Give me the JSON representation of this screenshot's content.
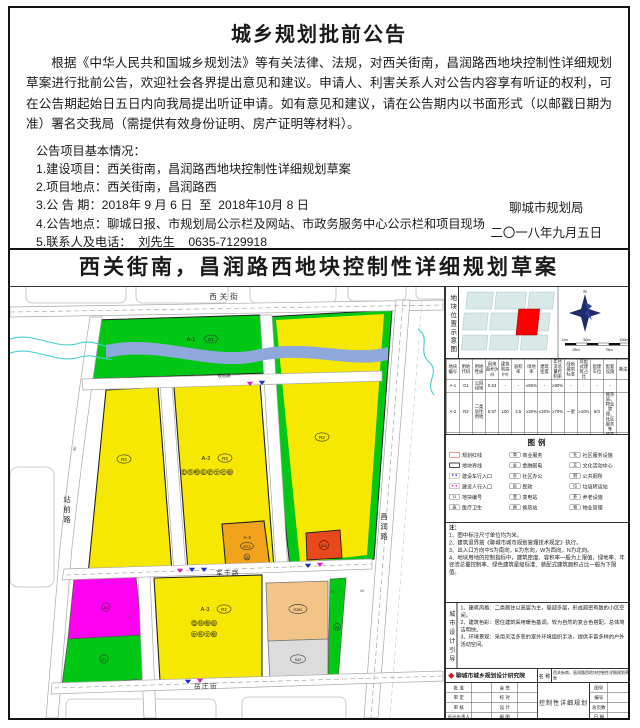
{
  "announcement": {
    "title": "城乡规划批前公告",
    "body": "根据《中华人民共和国城乡规划法》等有关法律、法规，对西关街南，昌润路西地块控制性详细规划草案进行批前公告，欢迎社会各界提出意见和建议。申请人、利害关系人对公告内容享有听证的权利，可在公告期起始日五日内向我局提出听证申请。如有意见和建议，请在公告期内以书面形式（以邮戳日期为准）署名交我局（需提供有效身份证明、房产证明等材料）。",
    "info_heading": "公告项目基本情况：",
    "items": [
      "1.建设项目：西关街南，昌润路西地块控制性详细规划草案",
      "2.项目地点：西关街南，昌润路西",
      "3.公 告 期：2018年 9 月 6 日  至  2018年10月 8 日",
      "4.公告地点：聊城日报、市规划局公示栏及网站、市政务服务中心公示栏和项目现场",
      "5.联系人及电话：  刘先生    0635-7129918"
    ],
    "signature_org": "聊城市规划局",
    "signature_date": "二〇一八年九月五日"
  },
  "map": {
    "title": "西关街南，昌润路西地块控制性详细规划草案",
    "roads": {
      "xiguan": "西关街",
      "zhanqian": "站前路",
      "changrun": "昌润路",
      "jungan": "军干路",
      "yuezhuang": "岳庄街",
      "guihua": "规划路"
    },
    "dims": {
      "d40a": "40",
      "d30": "30",
      "d16": "16",
      "d20": "20",
      "d40b": "40"
    },
    "blocks": {
      "a1_no": "A-1",
      "a1_code": "G1",
      "west_code": "R2",
      "a2_no": "A-2",
      "a2_code": "R2",
      "a2_amenities": "电热物居老文社厕",
      "east_code": "R2",
      "a4_no": "A-4",
      "a4_code": "R22",
      "a4_amenity": "幼",
      "a3_no": "A-3",
      "a3_code": "R2",
      "a3_amenities1": "电热物居",
      "a3_amenities2": "办民文厕",
      "magenta_code": "B4",
      "magenta_green_code": "G1",
      "red_code": "B41",
      "tan_code": "R2B1",
      "gray_code": "S42",
      "strip_code": "G2"
    }
  },
  "panel": {
    "inset": {
      "label": "地块位置示意图",
      "north": "N",
      "scale": [
        "0m",
        "25m",
        "50m",
        "75m",
        "100m"
      ]
    },
    "table": {
      "headers": [
        "地块编号",
        "用地代码",
        "用地性质",
        "用地面积(ha)",
        "建筑限高(m)",
        "容积率",
        "绿地率",
        "建筑密度",
        "年径流总量控制率",
        "绿色建筑标准",
        "装配式建筑占比",
        "配建车位",
        "配套设施",
        "备注"
      ],
      "rows": [
        [
          "A-1",
          "G1",
          "公园绿地",
          "0.53",
          "-",
          "-",
          "≥85%",
          "-",
          "≥90%",
          "-",
          "-",
          "-",
          "-",
          ""
        ],
        [
          "A-2",
          "R2",
          "二类居住用地",
          "5.57",
          "100",
          "2.5",
          "≥30%",
          "≤20%",
          "≥70%",
          "一星",
          "≥10%",
          "9/3",
          "换热站、物业管理、社区服务等",
          ""
        ],
        [
          "A-3",
          "R2",
          "二类居住用地",
          "3.88",
          "100",
          "2.8",
          "≥30%",
          "≤20%",
          "≥70%",
          "一星",
          "≥10%",
          "9/3",
          "换热站、物业管理、社区办公等",
          "代征"
        ],
        [
          "A-4",
          "R22",
          "服务设施用地",
          "0.53",
          "24",
          "0.8",
          "≥30%",
          "≤30%",
          "≥70%",
          "一星",
          "≥10%",
          "9/4",
          "幼儿园",
          ""
        ]
      ]
    },
    "legend": {
      "title": "图例",
      "columns": [
        [
          {
            "type": "rect-red",
            "label": "规划红线"
          },
          {
            "type": "rect-dark",
            "label": "地块界线"
          },
          {
            "type": "arrow-blue",
            "char": "▼▼",
            "label": "建设车行入口"
          },
          {
            "type": "arrow-magenta",
            "char": "▼▼",
            "label": "建设人行入口"
          },
          {
            "type": "char",
            "char": "11",
            "label": "地块编号"
          },
          {
            "type": "char",
            "char": "医",
            "label": "医疗卫生"
          }
        ],
        [
          {
            "type": "char",
            "char": "商",
            "label": "商业服务"
          },
          {
            "type": "char",
            "char": "金",
            "label": "金融邮电"
          },
          {
            "type": "char",
            "char": "办",
            "label": "社区办公"
          },
          {
            "type": "char",
            "char": "民",
            "label": "民政"
          },
          {
            "type": "char",
            "char": "变",
            "label": "变电站"
          },
          {
            "type": "char",
            "char": "换",
            "label": "换热站"
          }
        ],
        [
          {
            "type": "char",
            "char": "社",
            "label": "社区服务设施"
          },
          {
            "type": "char",
            "char": "文",
            "label": "文化活动中心"
          },
          {
            "type": "char",
            "char": "厕",
            "label": "公共厕所"
          },
          {
            "type": "char",
            "char": "垃",
            "label": "垃圾转运站"
          },
          {
            "type": "char",
            "char": "养",
            "label": "养老设施"
          },
          {
            "type": "char",
            "char": "物",
            "label": "物业管理"
          }
        ]
      ]
    },
    "notes_heading": "注：",
    "notes": [
      "1、图中标注尺寸单位均为米。",
      "2、建筑退界按《聊城市城市规划管理技术规定》执行。",
      "3、出入口方向中S为南向，E为东向，W为西向，N为北向。",
      "4、地块用地的控制指标中，建筑密度、容积率一般为上限值，绿地率、年径流总量控制率、绿色建筑星级标准、装配式建筑面积占比一般为下限值。"
    ],
    "design_label": "城市设计引导",
    "design_items": [
      "1、建筑风格：二类居住以高层为主，局部多层，形成疏密有致的小区空间。",
      "2、建筑色彩：居住建筑采用暖色基调，较为自然的复合色搭配，总体简洁明快。",
      "3、环境景观：采用灵活多变的室外环境组织手法，提供丰富多样的户外活动空间。"
    ],
    "titleblock": {
      "institute": "聊城市城乡规划设计研究院",
      "name_label": "名 称",
      "name_value": "西关街南，昌润路西地块控制性详细规划草案",
      "left_rows": [
        [
          "批 准",
          "会 签"
        ],
        [
          "审 定",
          "校 对"
        ],
        [
          "审 核",
          "设 计"
        ],
        [
          "设计负责人",
          "制 图"
        ]
      ],
      "center": "控制性详细规划",
      "right_rows": [
        "图号",
        "编号",
        "总页数",
        "日 期"
      ]
    }
  },
  "colors": {
    "residential_yellow": "#F6E800",
    "green_space": "#00C814",
    "commercial_magenta": "#FF00F0",
    "service_orange": "#F2A31C",
    "commercial_red": "#E8491C",
    "mixed_tan": "#F2C488",
    "parking_gray": "#DCDCDC",
    "water_blue": "#8FA8DC",
    "river_cyan": "#45CFCF"
  }
}
